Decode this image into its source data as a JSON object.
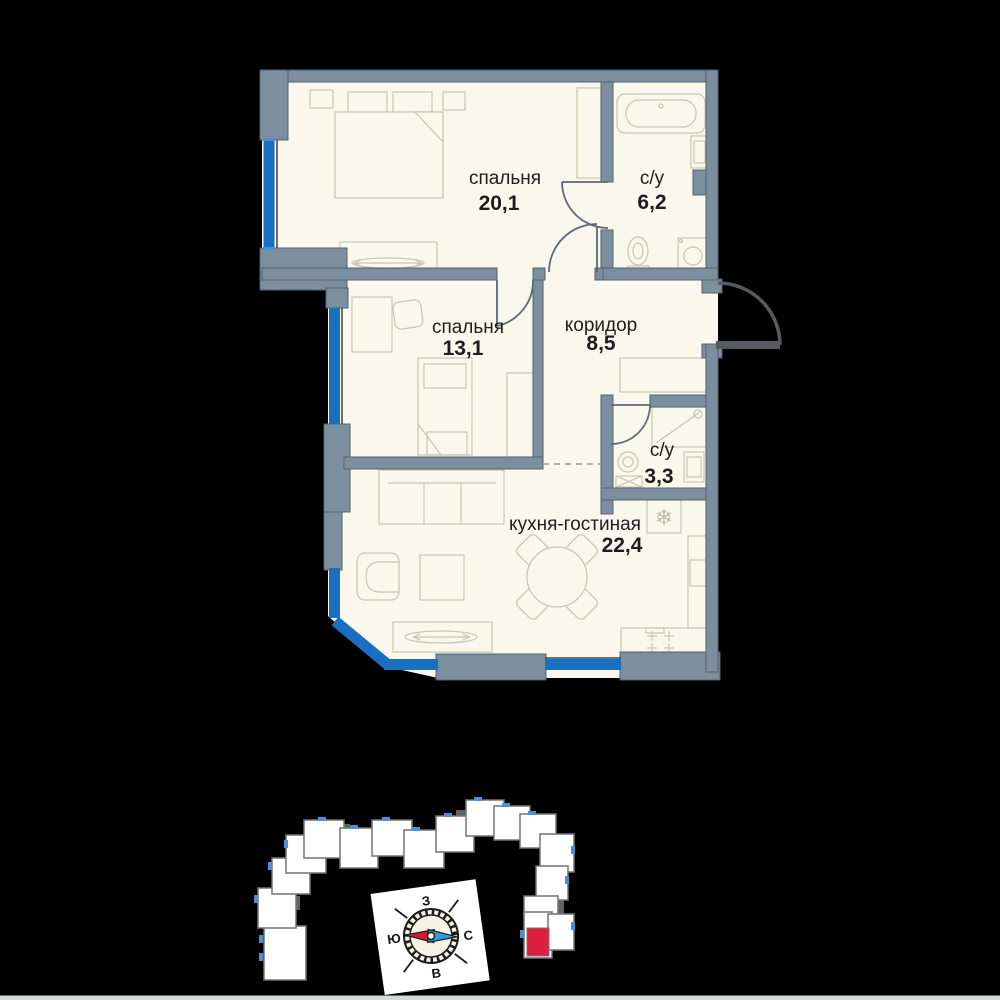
{
  "floor_plan": {
    "rooms": [
      {
        "id": "bedroom-1",
        "name": "спальня",
        "area": "20,1"
      },
      {
        "id": "bathroom-1",
        "name": "с/у",
        "area": "6,2"
      },
      {
        "id": "bedroom-2",
        "name": "спальня",
        "area": "13,1"
      },
      {
        "id": "corridor",
        "name": "коридор",
        "area": "8,5"
      },
      {
        "id": "bathroom-2",
        "name": "с/у",
        "area": "3,3"
      },
      {
        "id": "kitchen-living",
        "name": "кухня-гостиная",
        "area": "22,4"
      }
    ],
    "colors": {
      "background": "#000000",
      "wall": "#7b8f9f",
      "floor": "#faf8ec",
      "window_glazing": "#1b6fc1",
      "furniture_line": "#c9c5b2",
      "label_text": "#1d1d1d"
    },
    "icons": {
      "fridge_snowflake": "❄"
    }
  },
  "compass": {
    "labels": {
      "west": "З",
      "south": "Ю",
      "north": "С",
      "east": "В"
    },
    "colors": {
      "south_needle": "#d7182f",
      "north_needle": "#2a9fdf",
      "card": "#ffffff",
      "dial": "#f6f3e6"
    }
  },
  "site_plan": {
    "highlight_color": "#de1f3e",
    "building_fill": "#ffffff",
    "building_outline": "#707477",
    "window_tick": "#4a90d9"
  }
}
